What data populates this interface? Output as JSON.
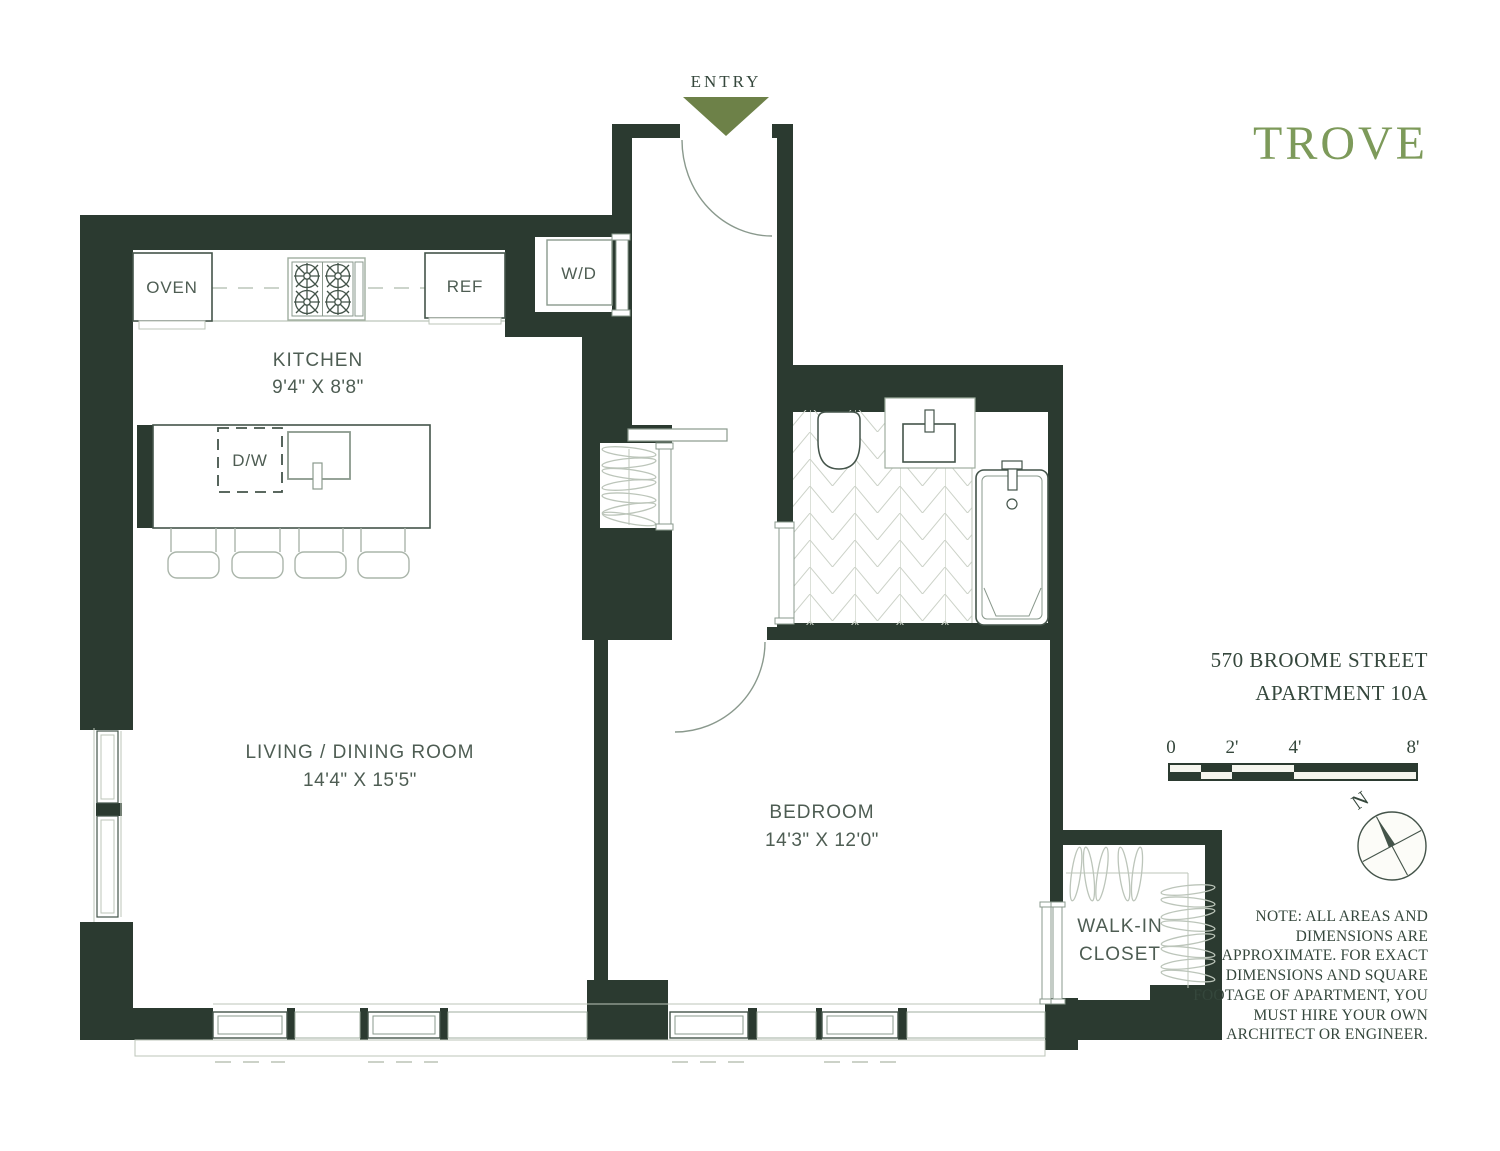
{
  "colors": {
    "wall": "#2b3a30",
    "entry_arrow": "#6d8148",
    "logo": "#7d9a5a",
    "serif_text": "#35473c",
    "label_text": "#4e5d53",
    "fixture_stroke": "#44544a",
    "mid_stroke": "#8a998d",
    "light_stroke": "#9fae9f",
    "faint_stroke": "#bcc5ba",
    "tile_stroke": "#ccd2c8",
    "seg_light": "#f5f5ee"
  },
  "plan": {
    "entry_label": "ENTRY",
    "rooms": {
      "kitchen": {
        "name": "KITCHEN",
        "dims": "9'4\" X 8'8\""
      },
      "living_dining": {
        "name": "LIVING / DINING ROOM",
        "dims": "14'4\" X 15'5\""
      },
      "bedroom": {
        "name": "BEDROOM",
        "dims": "14'3\" X 12'0\""
      },
      "walk_in_closet": {
        "name_line1": "WALK-IN",
        "name_line2": "CLOSET"
      }
    },
    "appliances": {
      "oven": "OVEN",
      "refrigerator": "REF",
      "washer_dryer": "W/D",
      "dishwasher": "D/W"
    }
  },
  "sidebar": {
    "logo": "TROVE",
    "address_line1": "570 BROOME STREET",
    "address_line2": "APARTMENT 10A",
    "scale_ticks": [
      "0",
      "2'",
      "4'",
      "8'"
    ],
    "compass_north": "N",
    "note_lines": [
      "NOTE: ALL AREAS AND",
      "DIMENSIONS ARE",
      "APPROXIMATE. FOR EXACT",
      "DIMENSIONS AND SQUARE",
      "FOOTAGE OF APARTMENT, YOU",
      "MUST HIRE YOUR OWN",
      "ARCHITECT OR ENGINEER."
    ]
  }
}
